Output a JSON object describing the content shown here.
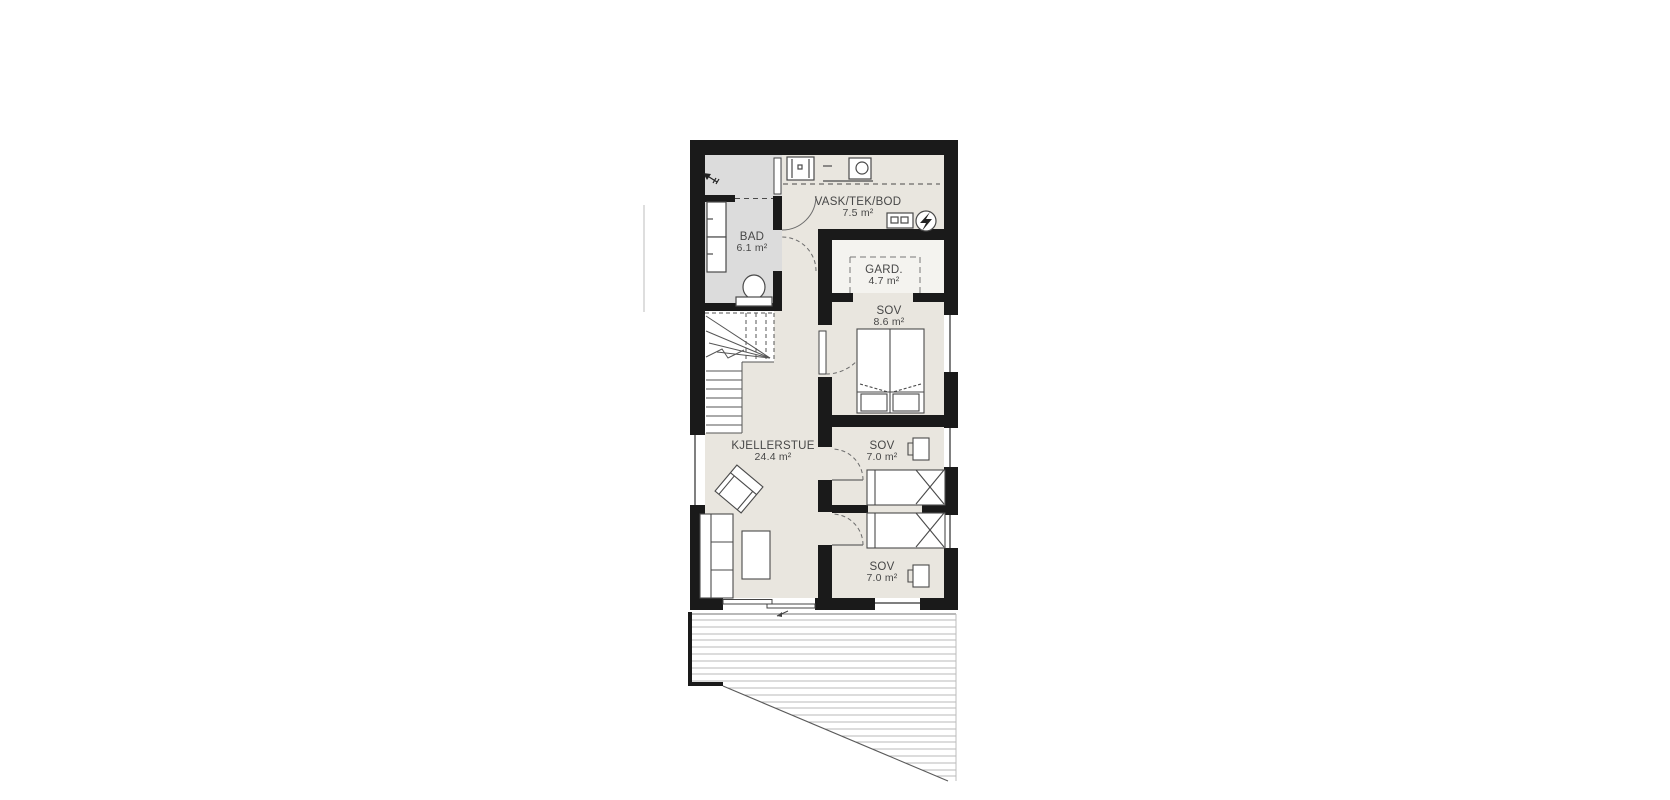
{
  "rooms": [
    {
      "id": "bad",
      "name": "BAD",
      "area": "6.1 m²"
    },
    {
      "id": "vask",
      "name": "VASK/TEK/BOD",
      "area": "7.5 m²"
    },
    {
      "id": "gard",
      "name": "GARD.",
      "area": "4.7 m²"
    },
    {
      "id": "sov-main",
      "name": "SOV",
      "area": "8.6 m²"
    },
    {
      "id": "kjellerstue",
      "name": "KJELLERSTUE",
      "area": "24.4 m²"
    },
    {
      "id": "sov-mid",
      "name": "SOV",
      "area": "7.0 m²"
    },
    {
      "id": "sov-south",
      "name": "SOV",
      "area": "7.0 m²"
    }
  ],
  "icons": [
    "laundry-sink",
    "washing-machine",
    "water-heater",
    "electrical-panel",
    "toilet",
    "vanity-cabinet",
    "entry-arrow",
    "winder-stairs",
    "double-bed",
    "single-bed",
    "desk-chair",
    "armchair",
    "sofa",
    "coffee-table",
    "sliding-door",
    "door-swing-arc",
    "window",
    "terrace-decking"
  ],
  "colors": {
    "wall": "#1a1a1a",
    "floor_main": "#e9e6df",
    "floor_bath": "#dcdcdc",
    "floor_closet": "#f4f3ef",
    "furniture_line": "#4a4a4a",
    "label_text": "#474747",
    "deck_line": "#b8b8b8"
  }
}
